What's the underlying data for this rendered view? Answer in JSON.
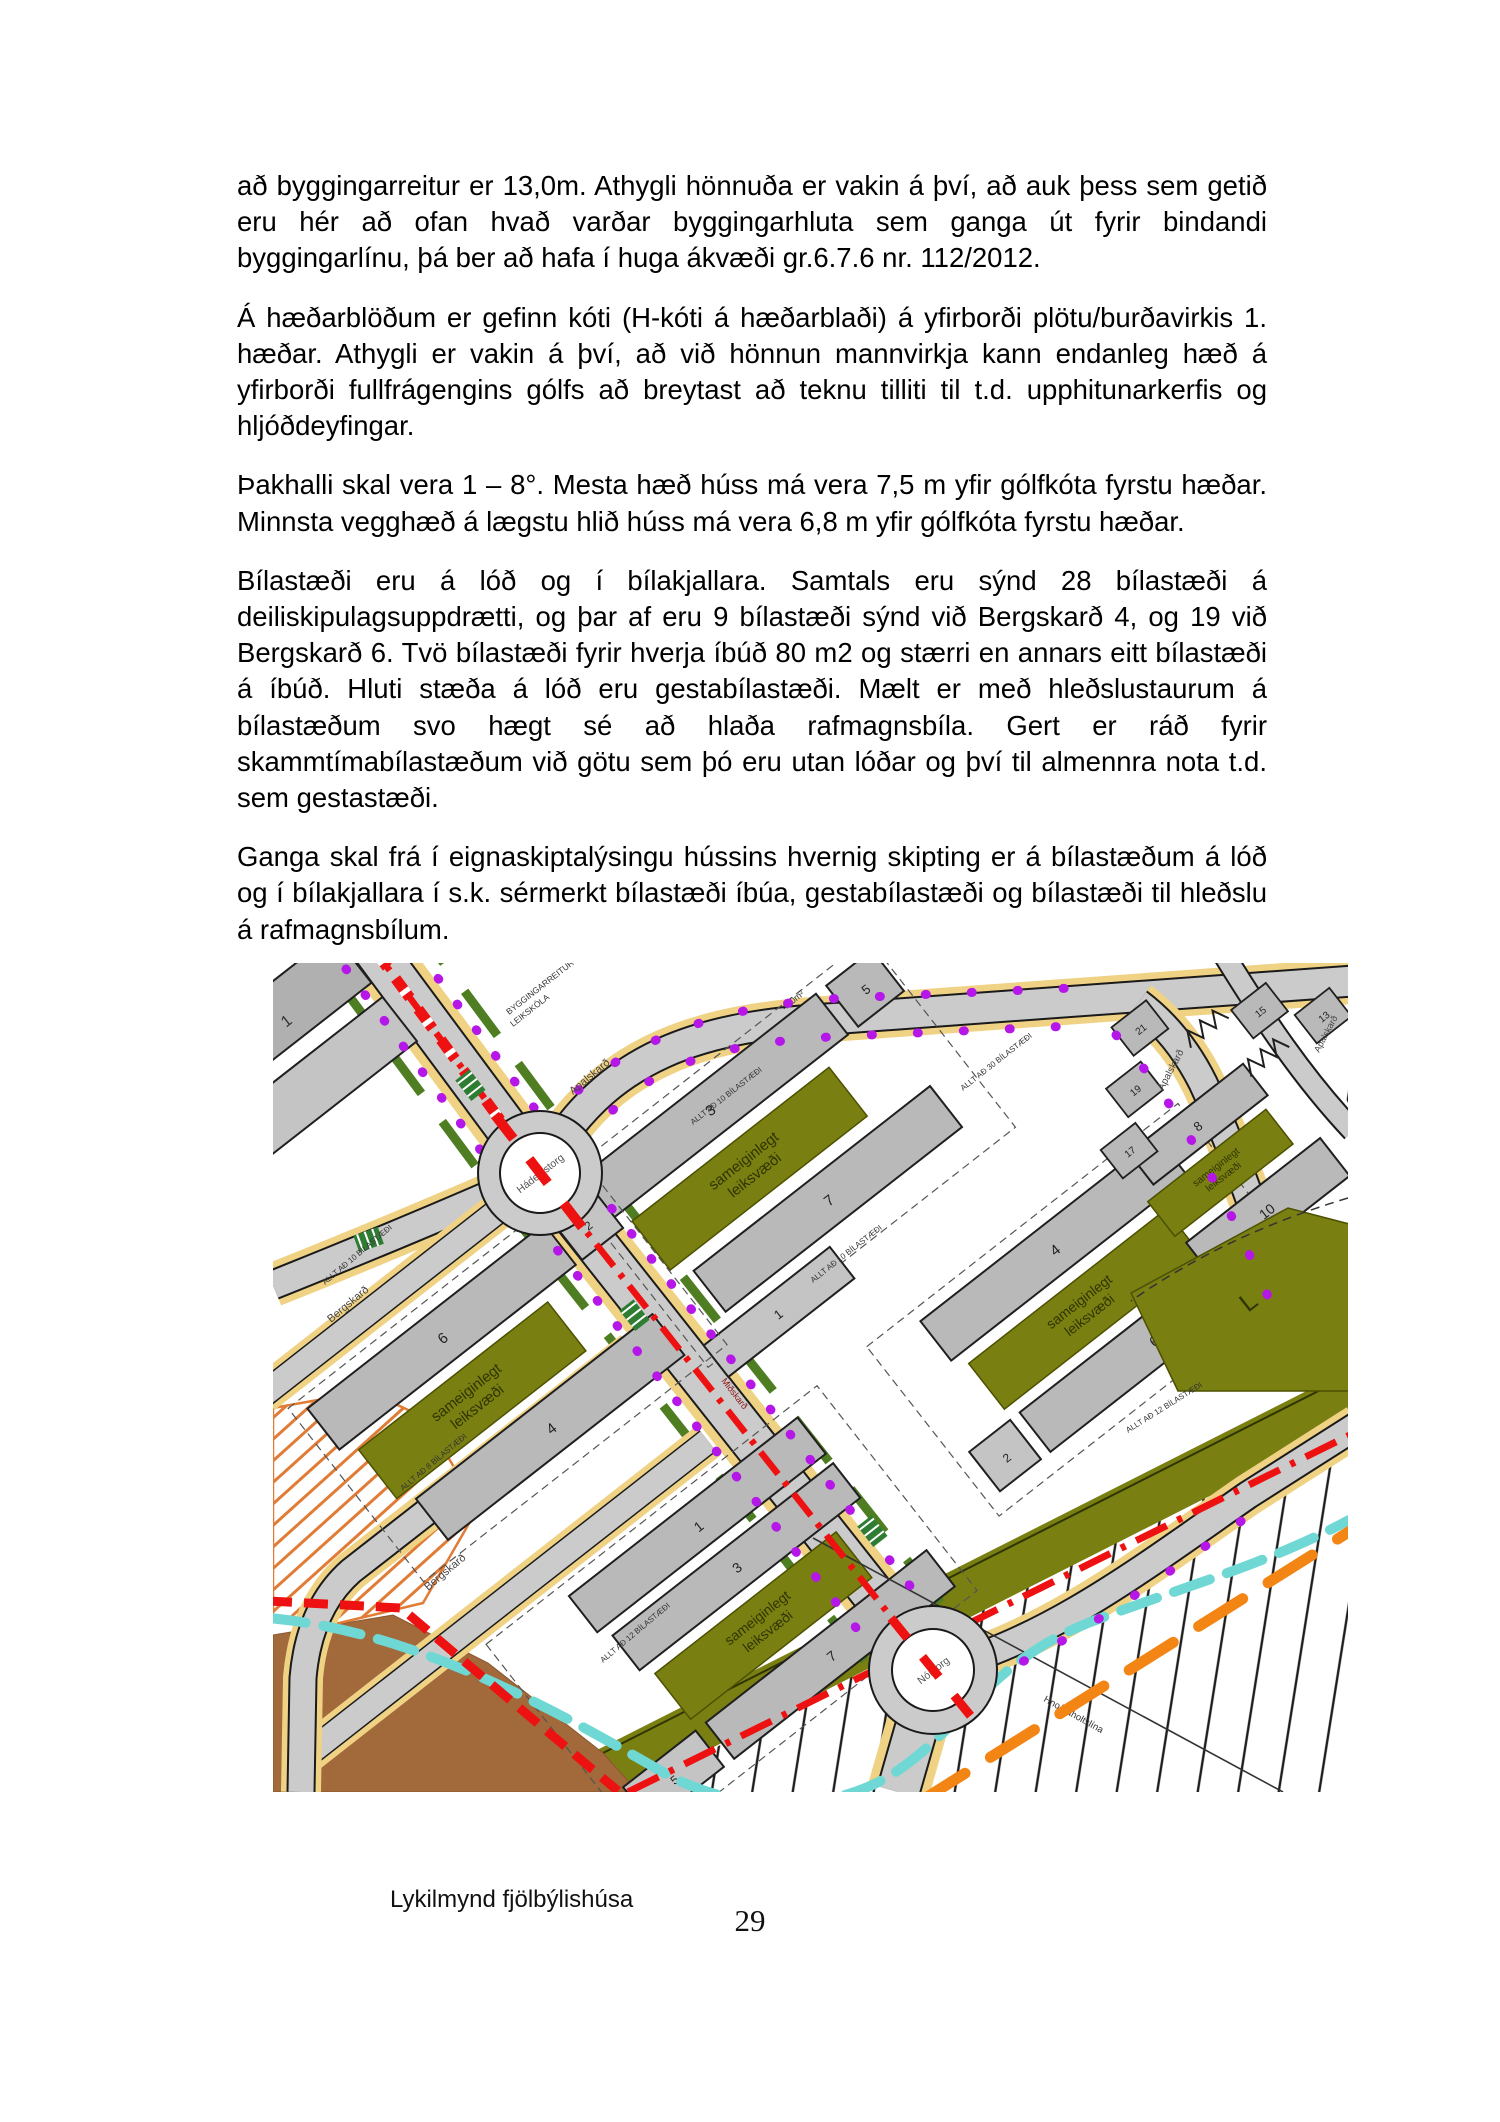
{
  "page": {
    "caption": "Lykilmynd fjölbýlishúsa",
    "number": "29"
  },
  "paragraphs": {
    "p1": "að byggingarreitur er 13,0m. Athygli hönnuða er vakin á því, að auk þess sem getið eru hér að ofan hvað varðar byggingarhluta sem ganga út fyrir bindandi byggingarlínu, þá ber að hafa í huga ákvæði  gr.6.7.6 nr. 112/2012.",
    "p2": "Á hæðarblöðum er gefinn kóti (H-kóti á hæðarblaði) á yfirborði plötu/burðavirkis 1. hæðar.  Athygli er vakin á því, að við hönnun mannvirkja kann endanleg hæð á yfirborði fullfrágengins gólfs að breytast að teknu tilliti til t.d. upphitunarkerfis og hljóðdeyfingar.",
    "p3": "Þakhalli skal vera 1 – 8°. Mesta hæð húss má vera 7,5 m yfir gólfkóta fyrstu hæðar. Minnsta vegghæð á lægstu hlið húss má vera 6,8 m yfir gólfkóta fyrstu hæðar.",
    "p4": "Bílastæði eru á lóð og í bílakjallara. Samtals eru sýnd 28 bílastæði á deiliskipulagsuppdrætti, og þar af eru 9 bílastæði sýnd við Bergskarð 4, og 19 við Bergskarð 6.  Tvö bílastæði fyrir hverja íbúð 80 m2 og stærri en annars eitt bílastæði á íbúð. Hluti stæða á lóð eru gestabílastæði. Mælt er með hleðslustaurum á bílastæðum svo hægt sé að hlaða  rafmagnsbíla. Gert er ráð fyrir skammtímabílastæðum við götu sem þó eru utan lóðar og því til almennra nota t.d. sem gestastæði.",
    "p5": "Ganga skal frá í eignaskiptalýsingu hússins hvernig skipting  er á bílastæðum á lóð og í bílakjallara í s.k. sérmerkt bílastæði íbúa, gestabílastæði og bílastæði til hleðslu á rafmagnsbílum."
  },
  "map": {
    "roundabout_1": "Hádegistorg",
    "roundabout_2": "Nóntorg",
    "street_apalskard": "Apalskarð",
    "street_bergskard": "Bergskarð",
    "street_central": "Miðskarð",
    "play_area_line1": "sameiginlegt",
    "play_area_line2": "leiksvæði",
    "preschool_line1": "BYGGINGARREITUR",
    "preschool_line2": "LEIKSKÓLA",
    "power_line": "Hnoðraholtslína",
    "open_area_letter": "L",
    "parking_note_10": "ALLT AÐ 10 BÍLASTÆÐI",
    "parking_note_12": "ALLT AÐ 12 BÍLASTÆÐI",
    "parking_note_30": "ALLT AÐ 30 BÍLASTÆÐI",
    "parking_note_8": "ALLT AÐ 8 BÍLASTÆÐI",
    "area_label": "480m²",
    "buildings": {
      "b1": "1",
      "b2": "2",
      "b3": "3",
      "b4": "4",
      "b5": "5",
      "b6": "6",
      "b7": "7",
      "b8": "8",
      "b10": "10"
    },
    "houses": {
      "h13": "13",
      "h15": "15",
      "h17": "17",
      "h19": "19",
      "h21": "21"
    },
    "colors": {
      "road_gray": "#cbcbcb",
      "building_gray": "#b9b9b9",
      "parking_tan": "#f0d285",
      "play_area_olive": "#7a7f12",
      "verge_green": "#4e7d22",
      "centerline_red": "#ee1111",
      "stream_cyan": "#6fd8d4",
      "powerline_orange": "#f28513",
      "soil_brown": "#a2693a",
      "dot_purple": "#b517e8",
      "hatch_orange": "#e07c35"
    }
  }
}
